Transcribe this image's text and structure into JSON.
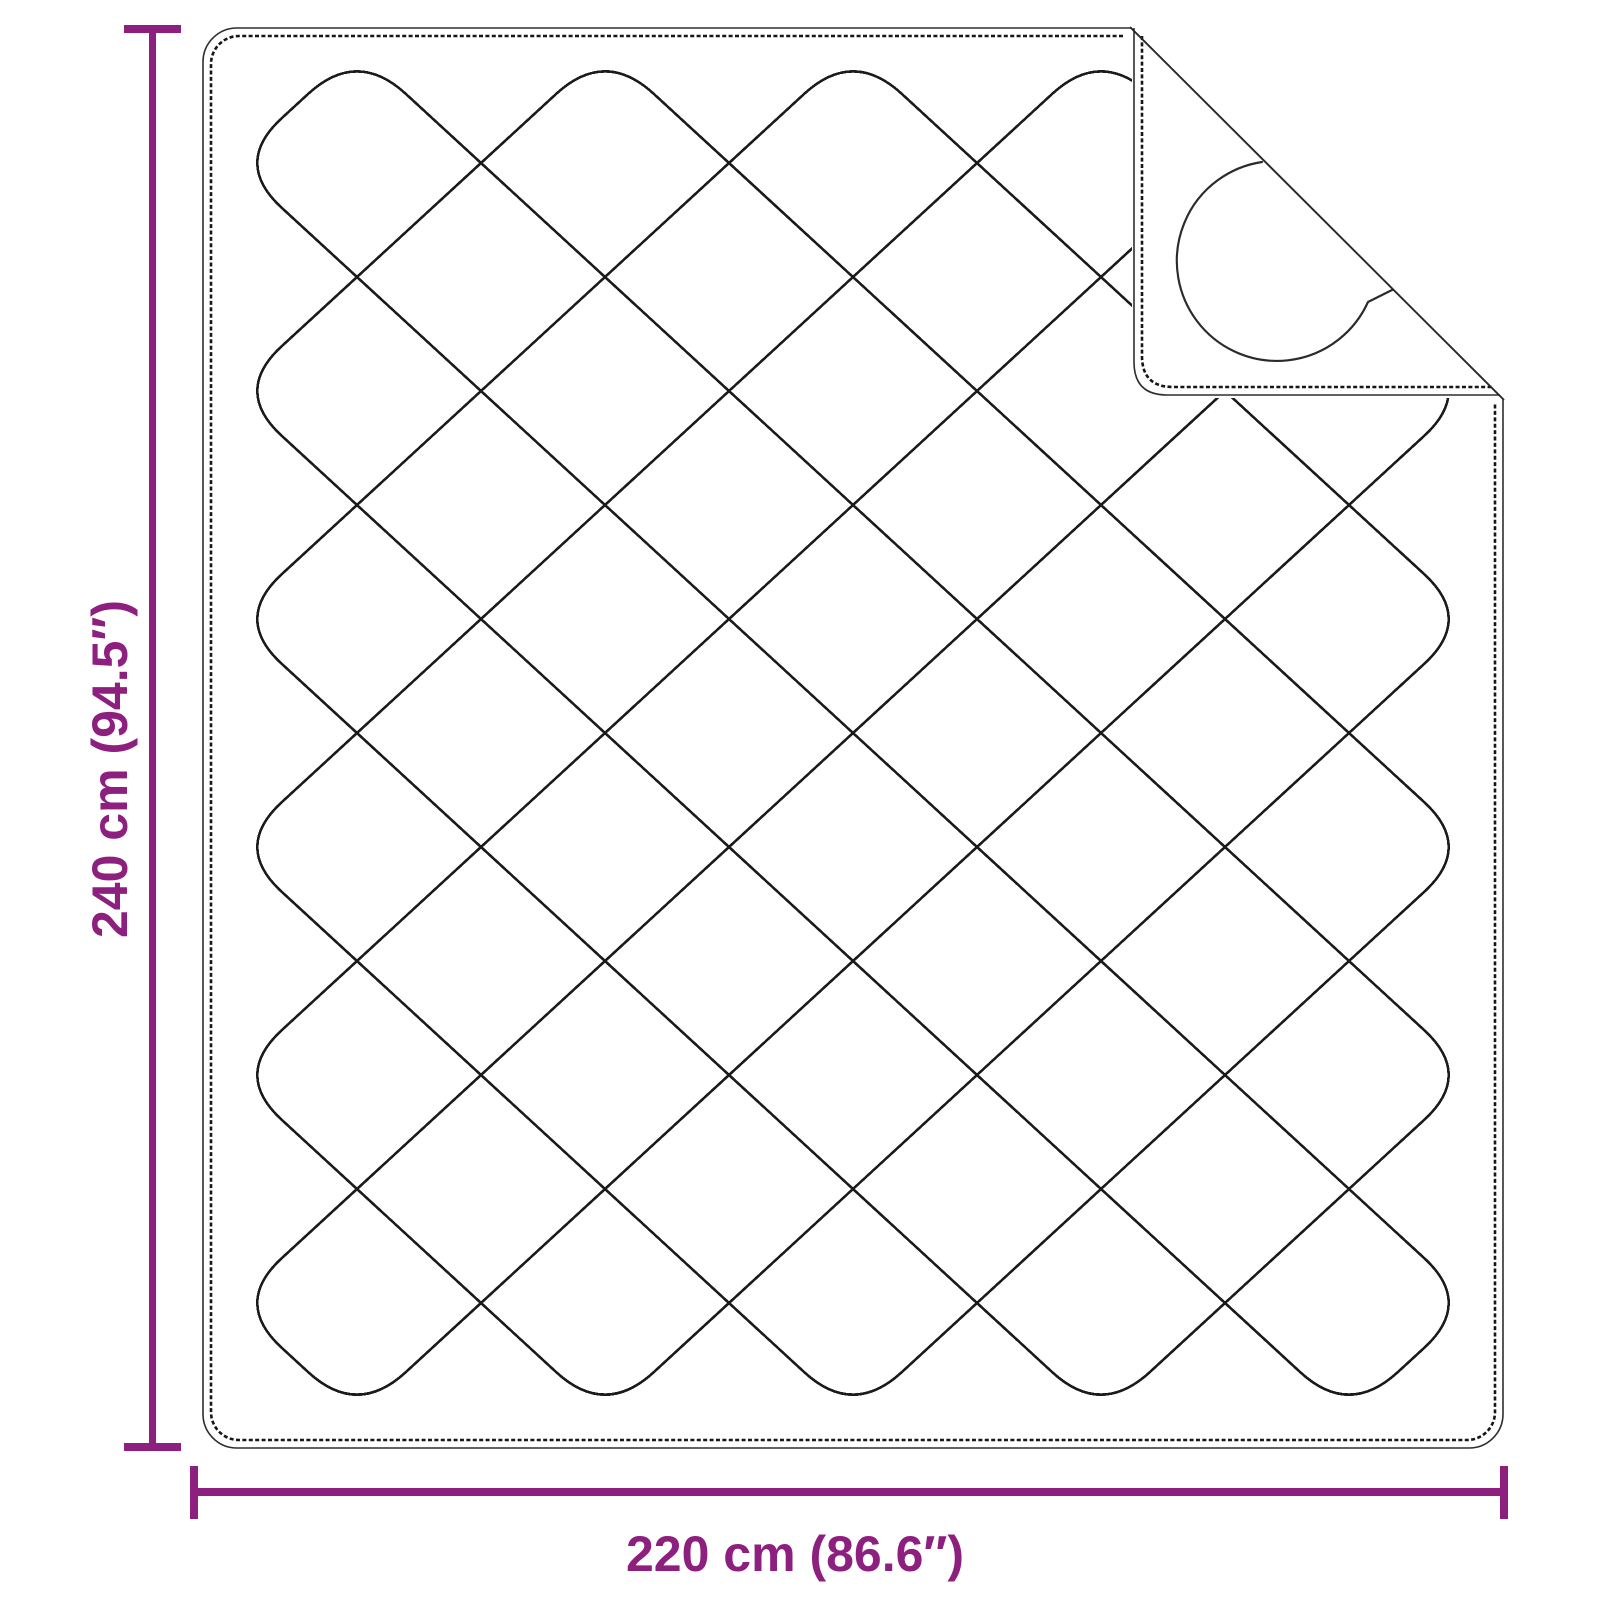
{
  "diagram": {
    "title": "Quilted blanket dimension diagram",
    "product": "quilted-blanket-with-folded-corner",
    "vertical_dimension": {
      "label": "240 cm (94.5″)",
      "value_metric": "240 cm",
      "value_imperial": "94.5″"
    },
    "horizontal_dimension": {
      "label": "220 cm (86.6″)",
      "value_metric": "220 cm",
      "value_imperial": "86.6″"
    },
    "colors": {
      "accent": "#8d1f7f",
      "stitch_line": "#1b1b1b",
      "outline": "#2e2e2e",
      "background": "#ffffff"
    }
  }
}
